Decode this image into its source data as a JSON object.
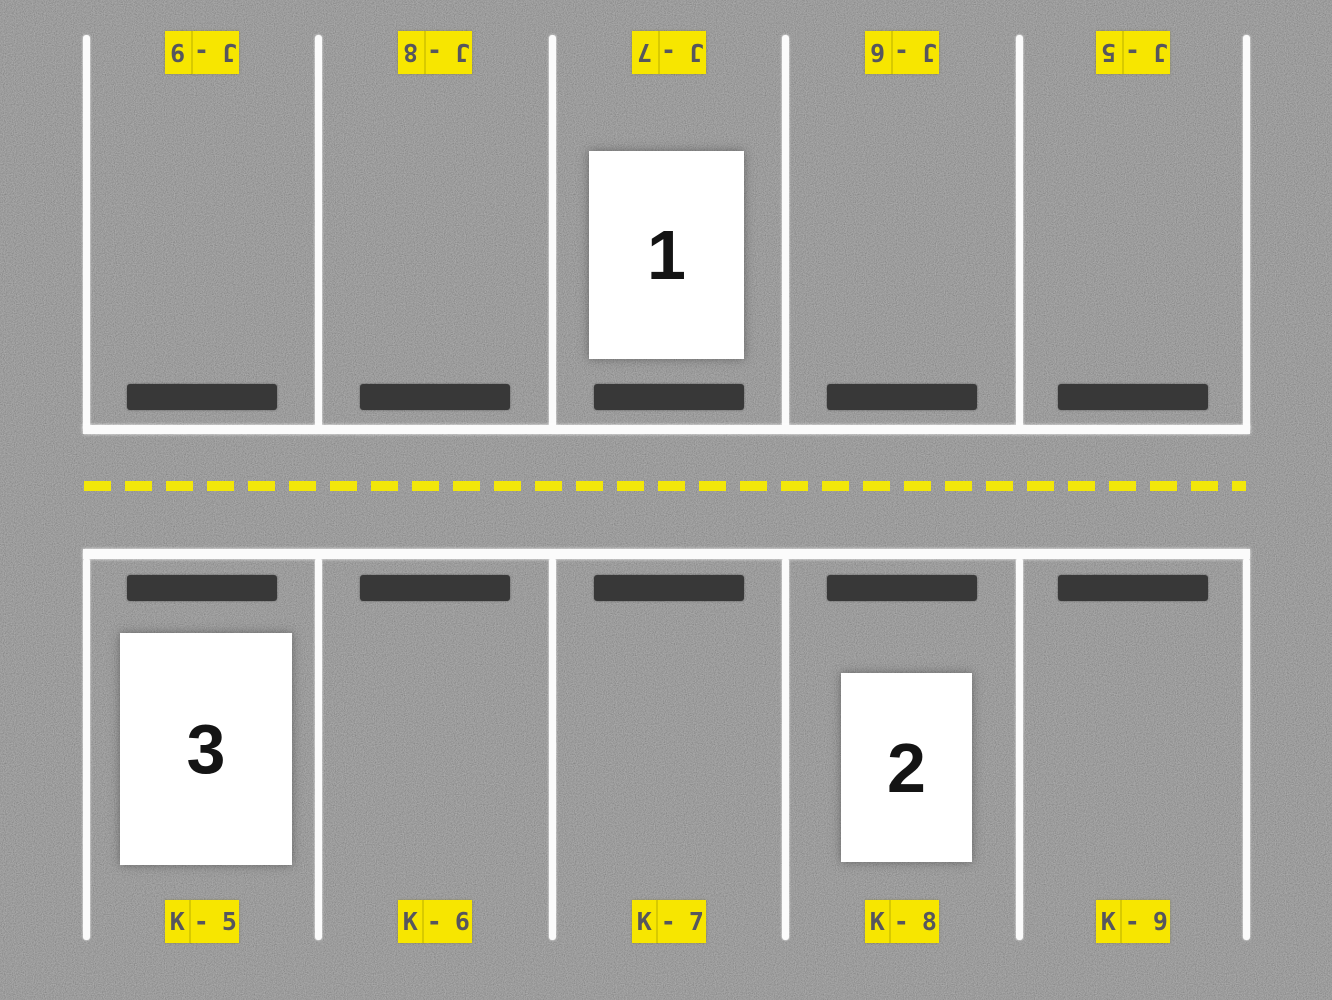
{
  "scene": {
    "description": "Top-down parking lot with two rows of five spaces separated by a dashed yellow lane line; three white numbered cards occupy spaces",
    "colors": {
      "asphalt": "#7d7d7d",
      "line_white": "#fbfbfb",
      "lane_dash_yellow": "#f2e70a",
      "label_yellow": "#f7e600",
      "label_text": "#56565e",
      "wheel_stop": "#383838",
      "card_white": "#ffffff",
      "card_digit": "#141414"
    }
  },
  "rows": {
    "top": {
      "letter": "J",
      "orientation": "labels painted upside-down (rotated 180 degrees)",
      "spaces": [
        {
          "id": "J - 9",
          "cell_a": "J -",
          "cell_b": "9"
        },
        {
          "id": "J - 8",
          "cell_a": "J -",
          "cell_b": "8"
        },
        {
          "id": "J - 7",
          "cell_a": "J -",
          "cell_b": "7",
          "marker": "1"
        },
        {
          "id": "J - 6",
          "cell_a": "J -",
          "cell_b": "6"
        },
        {
          "id": "J - 5",
          "cell_a": "J -",
          "cell_b": "5"
        }
      ]
    },
    "bottom": {
      "letter": "K",
      "orientation": "labels painted upright",
      "spaces": [
        {
          "id": "K - 5",
          "cell_a": "K",
          "cell_b": "- 5",
          "marker": "3"
        },
        {
          "id": "K - 6",
          "cell_a": "K",
          "cell_b": "- 6"
        },
        {
          "id": "K - 7",
          "cell_a": "K",
          "cell_b": "- 7"
        },
        {
          "id": "K - 8",
          "cell_a": "K",
          "cell_b": "- 8",
          "marker": "2"
        },
        {
          "id": "K - 9",
          "cell_a": "K",
          "cell_b": "- 9"
        }
      ]
    }
  },
  "markers": [
    {
      "number": "1",
      "space": "J - 7"
    },
    {
      "number": "2",
      "space": "K - 8"
    },
    {
      "number": "3",
      "space": "K - 5"
    }
  ]
}
